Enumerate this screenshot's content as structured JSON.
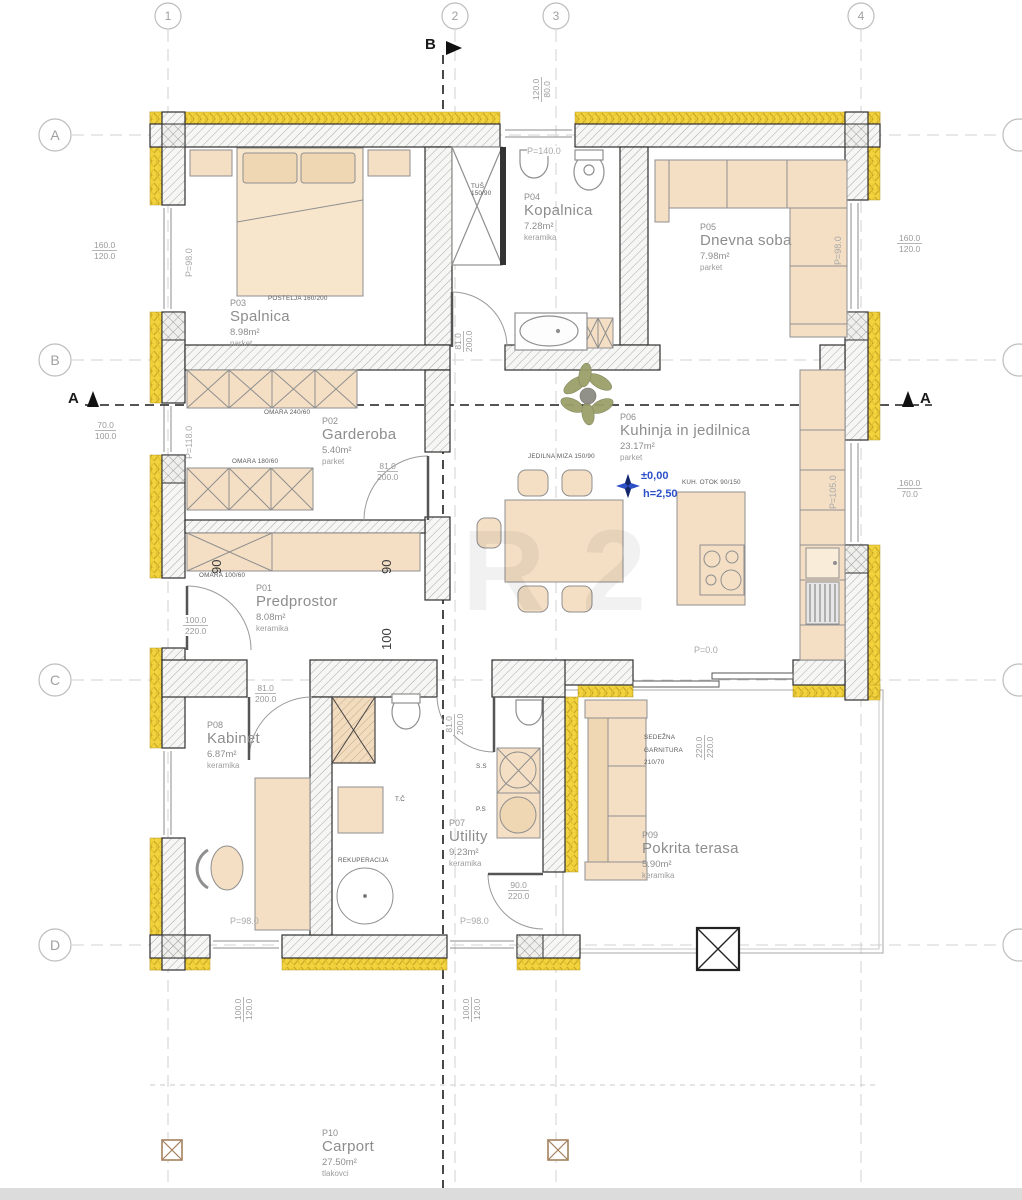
{
  "grid": {
    "columns": [
      "1",
      "2",
      "3",
      "4"
    ],
    "rows": [
      "A",
      "B",
      "C",
      "D"
    ]
  },
  "sections": {
    "a": "A",
    "b": "B"
  },
  "level_marker": {
    "level": "±0,00",
    "height": "h=2,50"
  },
  "rooms": [
    {
      "id": "P01",
      "name": "Predprostor",
      "area": "8.08m²",
      "floor": "keramika"
    },
    {
      "id": "P02",
      "name": "Garderoba",
      "area": "5.40m²",
      "floor": "parket"
    },
    {
      "id": "P03",
      "name": "Spalnica",
      "area": "8.98m²",
      "floor": "parket"
    },
    {
      "id": "P04",
      "name": "Kopalnica",
      "area": "7.28m²",
      "floor": "keramika"
    },
    {
      "id": "P05",
      "name": "Dnevna soba",
      "area": "7.98m²",
      "floor": "parket"
    },
    {
      "id": "P06",
      "name": "Kuhinja in jedilnica",
      "area": "23.17m²",
      "floor": "parket"
    },
    {
      "id": "P07",
      "name": "Utility",
      "area": "9.23m²",
      "floor": "keramika"
    },
    {
      "id": "P08",
      "name": "Kabinet",
      "area": "6.87m²",
      "floor": "keramika"
    },
    {
      "id": "P09",
      "name": "Pokrita terasa",
      "area": "5.90m²",
      "floor": "keramika"
    },
    {
      "id": "P10",
      "name": "Carport",
      "area": "27.50m²",
      "floor": "tlakovci"
    }
  ],
  "furniture": {
    "bed": "POSTELJA 160/200",
    "wardrobe_240": "OMARA 240/60",
    "wardrobe_180": "OMARA 180/60",
    "wardrobe_100": "OMARA 100/60",
    "shower_1": "TUŠ",
    "shower_2": "150/90",
    "dining_table": "JEDILNA MIZA 150/90",
    "kitchen_island": "KUH. OTOK 90/150",
    "terrace_sofa_1": "SEDEŽNA",
    "terrace_sofa_2": "GARNITURA",
    "terrace_sofa_3": "210/70",
    "recuperation": "REKUPERACIJA",
    "heat_pump": "T.Č",
    "dryer": "S.S",
    "washer": "P.S"
  },
  "dimensions": {
    "window_top": {
      "w": "120.0",
      "h": "80.0"
    },
    "window_spalnica": {
      "w": "160.0",
      "h": "120.0"
    },
    "window_dnevna": {
      "w": "160.0",
      "h": "120.0"
    },
    "window_garderoba": {
      "w": "70.0",
      "h": "100.0"
    },
    "window_kuhinja": {
      "w": "160.0",
      "h": "70.0"
    },
    "door_entry": {
      "w": "100.0",
      "h": "220.0"
    },
    "door_garderoba": {
      "w": "81.0",
      "h": "200.0"
    },
    "door_kopalnica": {
      "w": "81.0",
      "h": "200.0"
    },
    "door_kabinet": {
      "w": "81.0",
      "h": "200.0"
    },
    "door_utility": {
      "w": "81.0",
      "h": "200.0"
    },
    "door_terasa": {
      "w": "90.0",
      "h": "220.0"
    },
    "window_kabinet": {
      "w": "100.0",
      "h": "120.0"
    },
    "window_utility": {
      "w": "100.0",
      "h": "120.0"
    },
    "terrace": {
      "w": "220.0",
      "h": "220.0"
    },
    "pass_90_left": "90",
    "pass_90_right": "90",
    "pass_100": "100"
  },
  "parapets": {
    "spalnica": "P=98.0",
    "dnevna": "P=98.0",
    "garderoba": "P=118.0",
    "kopalnica": "P=140.0",
    "kuhinja": "P=105.0",
    "kabinet": "P=98.0",
    "utility": "P=98.0",
    "terasa": "P=0.0"
  },
  "watermark": {
    "l1": "R",
    "l2": "2"
  },
  "colors": {
    "insulation": "#f2d23d",
    "furniture": "#f4dfc4",
    "level_blue": "#2b50c8"
  }
}
